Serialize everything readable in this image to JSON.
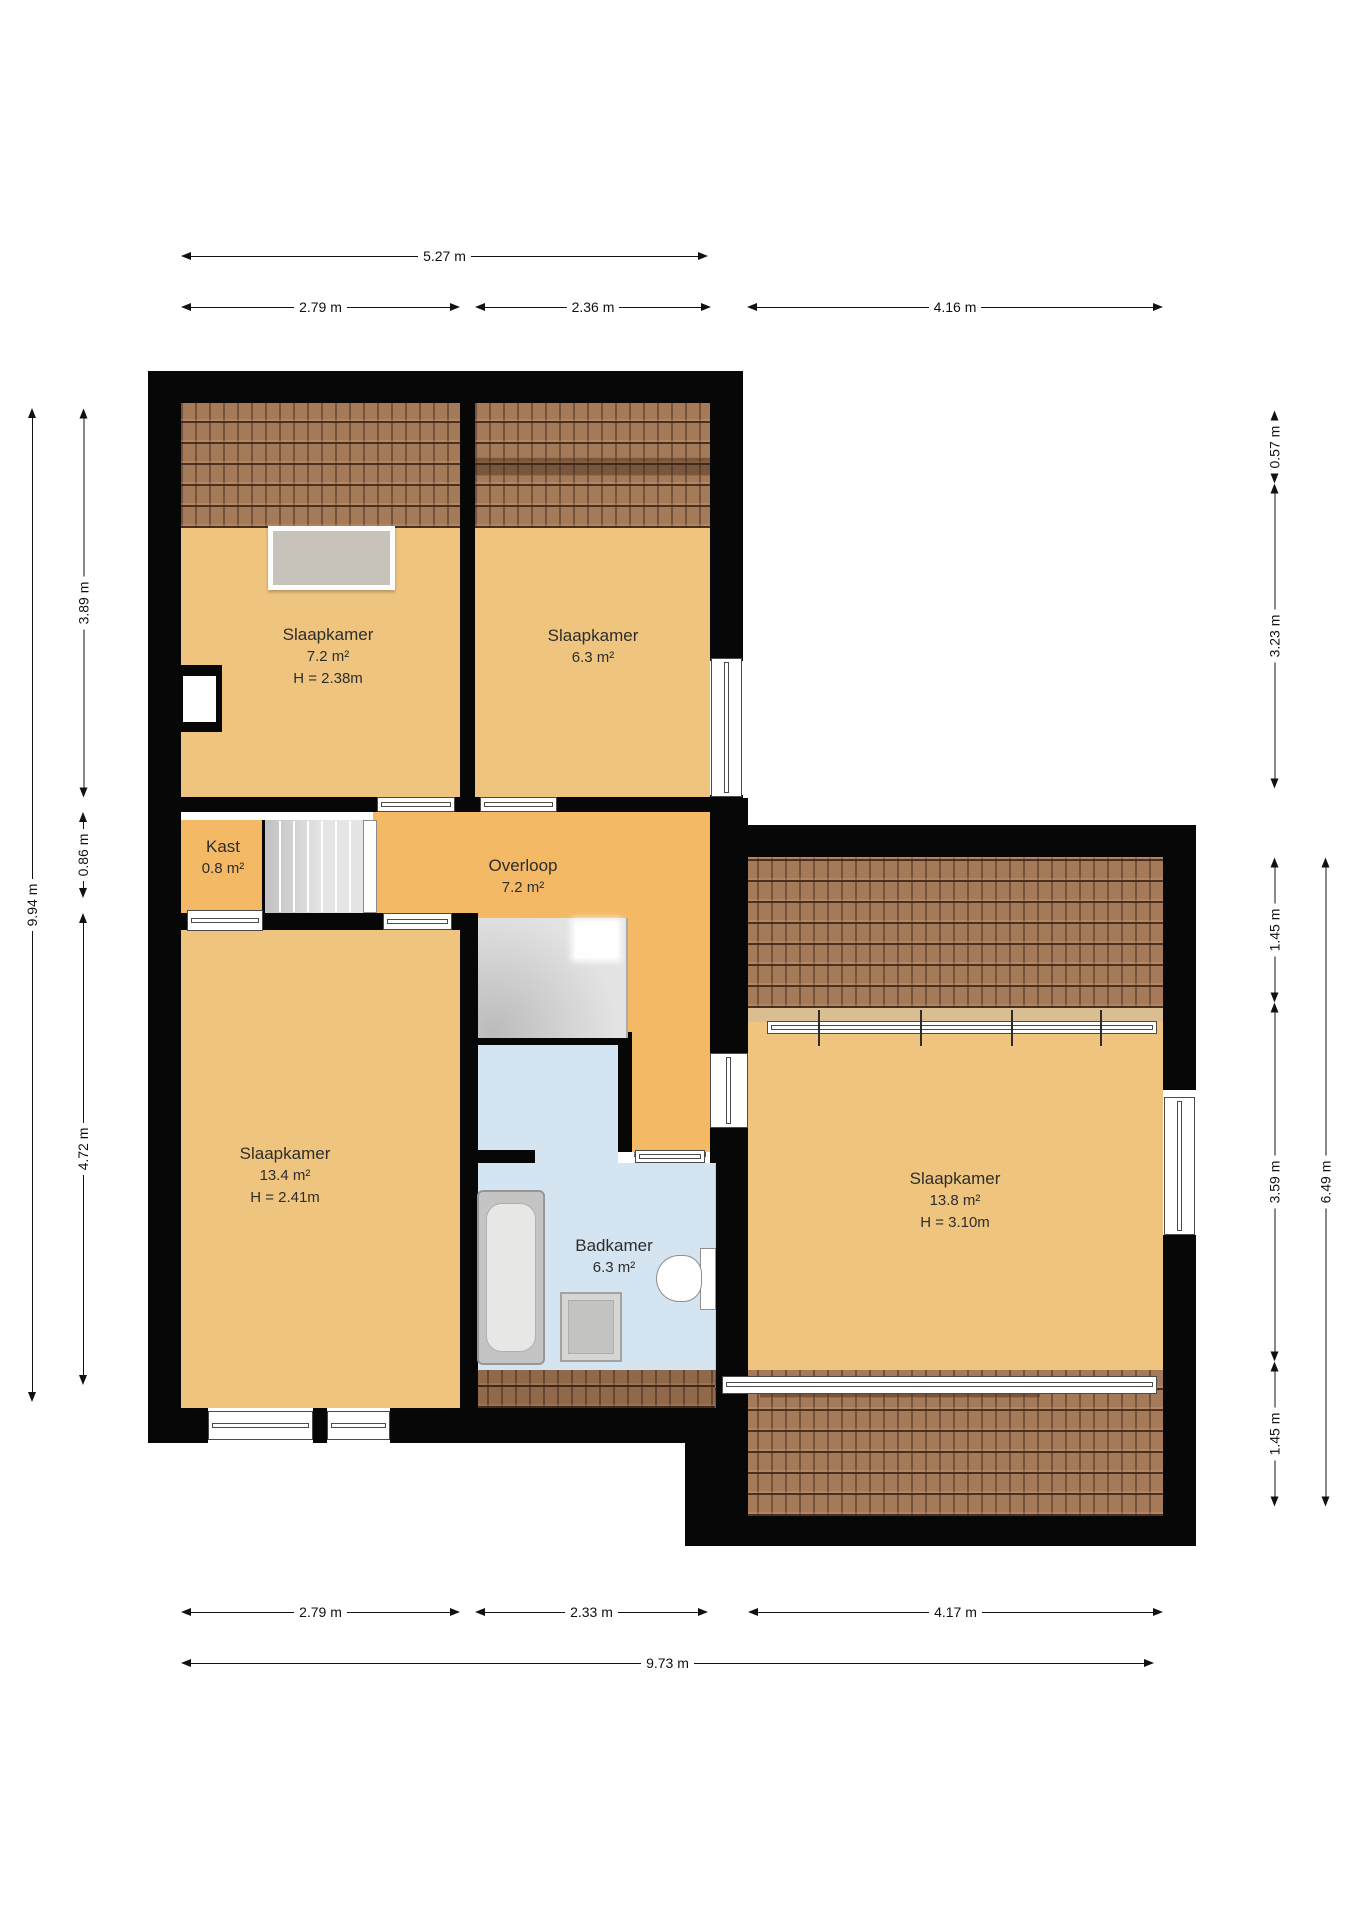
{
  "meta": {
    "type": "floorplan",
    "unit": "m",
    "floor_note": ""
  },
  "colors": {
    "bedroom": "#eec47e",
    "hall": "#f3b964",
    "bath": "#d5e4f1",
    "roof": "#a57a58",
    "wall": "#070707",
    "tan": "#dabd90",
    "stair": "#dcdcdc",
    "label": "#2d2d2d"
  },
  "rooms": [
    {
      "id": "slaapkamer-1",
      "lines": [
        "Slaapkamer",
        "7.2 m²",
        "H = 2.38m"
      ],
      "cx": 328,
      "cy": 657
    },
    {
      "id": "slaapkamer-2",
      "lines": [
        "Slaapkamer",
        "6.3 m²"
      ],
      "cx": 593,
      "cy": 647
    },
    {
      "id": "kast",
      "lines": [
        "Kast",
        "0.8 m²"
      ],
      "cx": 223,
      "cy": 858
    },
    {
      "id": "overloop",
      "lines": [
        "Overloop",
        "7.2 m²"
      ],
      "cx": 523,
      "cy": 877
    },
    {
      "id": "slaapkamer-3",
      "lines": [
        "Slaapkamer",
        "13.4 m²",
        "H = 2.41m"
      ],
      "cx": 285,
      "cy": 1176
    },
    {
      "id": "badkamer",
      "lines": [
        "Badkamer",
        "6.3 m²"
      ],
      "cx": 614,
      "cy": 1257
    },
    {
      "id": "slaapkamer-4",
      "lines": [
        "Slaapkamer",
        "13.8 m²",
        "H = 3.10m"
      ],
      "cx": 955,
      "cy": 1201
    }
  ],
  "floors": [
    {
      "id": "floor-slaapkamer-1",
      "x": 181,
      "y": 403,
      "w": 279,
      "h": 394,
      "fill": "bedroom"
    },
    {
      "id": "floor-slaapkamer-2",
      "x": 475,
      "y": 403,
      "w": 235,
      "h": 394,
      "fill": "bedroom"
    },
    {
      "id": "floor-kast",
      "x": 181,
      "y": 820,
      "w": 84,
      "h": 93,
      "fill": "hall"
    },
    {
      "id": "floor-overloop-main",
      "x": 373,
      "y": 812,
      "w": 337,
      "h": 101,
      "fill": "hall"
    },
    {
      "id": "floor-overloop-mid",
      "x": 478,
      "y": 913,
      "w": 232,
      "h": 10,
      "fill": "hall"
    },
    {
      "id": "floor-overloop-east",
      "x": 628,
      "y": 918,
      "w": 82,
      "h": 234,
      "fill": "hall"
    },
    {
      "id": "floor-slaapkamer-3",
      "x": 181,
      "y": 930,
      "w": 279,
      "h": 478,
      "fill": "bedroom"
    },
    {
      "id": "floor-shower",
      "x": 478,
      "y": 1045,
      "w": 140,
      "h": 105,
      "fill": "bath"
    },
    {
      "id": "floor-bath-link",
      "x": 535,
      "y": 1150,
      "w": 83,
      "h": 13,
      "fill": "bath"
    },
    {
      "id": "floor-badkamer",
      "x": 478,
      "y": 1163,
      "w": 238,
      "h": 207,
      "fill": "bath"
    },
    {
      "id": "floor-slaapkamer-4",
      "x": 715,
      "y": 857,
      "w": 448,
      "h": 659,
      "fill": "bedroom"
    },
    {
      "id": "floor-tan-strip",
      "x": 715,
      "y": 1008,
      "w": 448,
      "h": 14,
      "fill": "tan"
    }
  ],
  "roofs": [
    {
      "id": "roof-top-left",
      "x": 181,
      "y": 403,
      "w": 531,
      "h": 125,
      "dark": false
    },
    {
      "id": "roof-right-top",
      "x": 715,
      "y": 857,
      "w": 448,
      "h": 151,
      "dark": false
    },
    {
      "id": "roof-bath-strip",
      "x": 473,
      "y": 1370,
      "w": 243,
      "h": 38,
      "dark": true
    },
    {
      "id": "roof-right-bottom",
      "x": 715,
      "y": 1370,
      "w": 448,
      "h": 146,
      "dark": false
    }
  ],
  "roof_shades": [
    {
      "id": "roof-shade-top",
      "x": 473,
      "y": 457,
      "w": 239,
      "h": 17
    },
    {
      "id": "roof-shade-bottom",
      "x": 760,
      "y": 1377,
      "w": 280,
      "h": 19
    }
  ],
  "walls": [
    [
      148,
      371,
      595,
      32
    ],
    [
      148,
      371,
      33,
      1072
    ],
    [
      710,
      371,
      33,
      290
    ],
    [
      710,
      795,
      33,
      30
    ],
    [
      460,
      371,
      15,
      441
    ],
    [
      181,
      797,
      196,
      15
    ],
    [
      455,
      797,
      25,
      15
    ],
    [
      557,
      797,
      156,
      15
    ],
    [
      148,
      913,
      39,
      17
    ],
    [
      263,
      913,
      120,
      17
    ],
    [
      452,
      913,
      26,
      17
    ],
    [
      460,
      913,
      18,
      497
    ],
    [
      262,
      820,
      4,
      93
    ],
    [
      465,
      1032,
      167,
      13
    ],
    [
      618,
      1045,
      14,
      107
    ],
    [
      478,
      1150,
      57,
      13
    ],
    [
      710,
      798,
      38,
      27
    ],
    [
      710,
      825,
      38,
      228
    ],
    [
      710,
      1128,
      38,
      35
    ],
    [
      716,
      1163,
      32,
      245
    ],
    [
      685,
      1408,
      63,
      138
    ],
    [
      148,
      1408,
      60,
      35
    ],
    [
      313,
      1408,
      14,
      35
    ],
    [
      390,
      1408,
      326,
      35
    ],
    [
      743,
      825,
      453,
      32
    ],
    [
      1163,
      825,
      33,
      265
    ],
    [
      1163,
      1235,
      33,
      311
    ],
    [
      685,
      1516,
      511,
      30
    ]
  ],
  "windows": [
    {
      "id": "window-slaapkamer2-east",
      "x": 711,
      "y": 658,
      "w": 31,
      "h": 139,
      "orient": "v"
    },
    {
      "id": "window-slaapkamer4-topband",
      "x": 767,
      "y": 1021,
      "w": 390,
      "h": 13,
      "orient": "h"
    },
    {
      "id": "window-slaapkamer4-east",
      "x": 1164,
      "y": 1097,
      "w": 31,
      "h": 138,
      "orient": "v"
    },
    {
      "id": "window-slaapkamer3-south-a",
      "x": 208,
      "y": 1411,
      "w": 105,
      "h": 29,
      "orient": "h"
    },
    {
      "id": "window-slaapkamer3-south-b",
      "x": 327,
      "y": 1411,
      "w": 63,
      "h": 29,
      "orient": "h"
    },
    {
      "id": "window-roofband-bottom",
      "x": 722,
      "y": 1376,
      "w": 435,
      "h": 18,
      "orient": "h"
    },
    {
      "id": "kast-door-band",
      "x": 187,
      "y": 910,
      "w": 76,
      "h": 21,
      "orient": "h"
    }
  ],
  "window_ticks": {
    "band_x": [
      818,
      920,
      1011,
      1100
    ],
    "y1": 1010,
    "y2": 1046
  },
  "door_bands": [
    {
      "id": "door-slaapkamer-1",
      "x": 377,
      "y": 797,
      "w": 78,
      "h": 15,
      "orient": "h"
    },
    {
      "id": "door-slaapkamer-2",
      "x": 480,
      "y": 797,
      "w": 77,
      "h": 15,
      "orient": "h"
    },
    {
      "id": "door-slaapkamer-3",
      "x": 383,
      "y": 913,
      "w": 69,
      "h": 17,
      "orient": "h"
    },
    {
      "id": "door-badkamer",
      "x": 635,
      "y": 1150,
      "w": 70,
      "h": 13,
      "orient": "h"
    },
    {
      "id": "door-slaapkamer-4",
      "x": 710,
      "y": 1053,
      "w": 38,
      "h": 75,
      "orient": "v"
    }
  ],
  "door_arcs": [
    {
      "id": "door-arc-slaapkamer-1",
      "path": "M455,800 A75,75 0 0 0 380,725",
      "leaf": [
        380,
        800,
        380,
        725
      ]
    },
    {
      "id": "door-arc-slaapkamer-2",
      "path": "M480,800 A77,77 0 0 1 557,723",
      "leaf": [
        557,
        800,
        557,
        723
      ]
    },
    {
      "id": "door-arc-slaapkamer-3",
      "path": "M452,925 A69,69 0 0 1 383,994",
      "leaf": [
        383,
        925,
        383,
        994
      ]
    },
    {
      "id": "door-arc-badkamer",
      "path": "M635,1157 A70,70 0 0 1 705,1087",
      "leaf": [
        705,
        1157,
        705,
        1087
      ]
    },
    {
      "id": "door-arc-slaapkamer-4",
      "path": "M748,1128 A75,75 0 0 0 823,1053",
      "leaf": [
        748,
        1053,
        823,
        1053
      ]
    }
  ],
  "extras": {
    "dormer": {
      "id": "dormer-window",
      "x": 268,
      "y": 526,
      "w": 127,
      "h": 64
    },
    "niche_outer": {
      "id": "wall-niche-outer",
      "x": 177,
      "y": 665,
      "w": 45,
      "h": 67
    },
    "niche_inner": {
      "id": "wall-niche-inner",
      "x": 183,
      "y": 676,
      "w": 33,
      "h": 46
    }
  },
  "stairs": {
    "flight": {
      "id": "stairs-upper-flight",
      "x": 265,
      "y": 820,
      "w": 98,
      "h": 93,
      "treads_x": [
        279,
        293,
        307,
        321,
        335,
        349
      ]
    },
    "railing": {
      "id": "stairs-railing",
      "x": 363,
      "y": 820,
      "w": 14,
      "h": 93
    },
    "winder": {
      "id": "stairs-winder",
      "x": 478,
      "y": 918,
      "w": 150,
      "h": 120,
      "pivot": [
        488,
        1034
      ],
      "edges": [
        [
          520,
          918
        ],
        [
          562,
          918
        ],
        [
          604,
          918
        ],
        [
          628,
          938
        ],
        [
          628,
          972
        ],
        [
          628,
          1006
        ]
      ],
      "landing": {
        "x": 575,
        "y": 922,
        "w": 43,
        "h": 36
      }
    },
    "rail2": {
      "x": 626,
      "y": 918,
      "w": 2,
      "h": 120
    }
  },
  "fixtures": {
    "bathtub": {
      "id": "bathtub",
      "x": 477,
      "y": 1190,
      "w": 68,
      "h": 175
    },
    "washer": {
      "id": "washer",
      "x": 560,
      "y": 1292,
      "w": 62,
      "h": 70
    },
    "toilet_tank": {
      "id": "toilet-tank",
      "x": 700,
      "y": 1248,
      "w": 16,
      "h": 62
    },
    "toilet_bowl": {
      "id": "toilet-bowl",
      "x": 656,
      "y": 1255,
      "w": 46,
      "h": 47
    },
    "shower_head": {
      "id": "shower-head",
      "cx": 519,
      "cy": 1089,
      "r": 14,
      "arm": [
        478,
        1088,
        507,
        1089
      ]
    }
  },
  "dims": {
    "h": [
      {
        "id": "dim-527",
        "y": 256,
        "x1": 181,
        "x2": 708,
        "label": "5.27 m"
      },
      {
        "id": "dim-279-top",
        "y": 307,
        "x1": 181,
        "x2": 460,
        "label": "2.79 m"
      },
      {
        "id": "dim-236-top",
        "y": 307,
        "x1": 475,
        "x2": 711,
        "label": "2.36 m"
      },
      {
        "id": "dim-416-top",
        "y": 307,
        "x1": 747,
        "x2": 1163,
        "label": "4.16 m"
      },
      {
        "id": "dim-279-bottom",
        "y": 1612,
        "x1": 181,
        "x2": 460,
        "label": "2.79 m"
      },
      {
        "id": "dim-233-bottom",
        "y": 1612,
        "x1": 475,
        "x2": 708,
        "label": "2.33 m"
      },
      {
        "id": "dim-417-bottom",
        "y": 1612,
        "x1": 748,
        "x2": 1163,
        "label": "4.17 m"
      },
      {
        "id": "dim-973-bottom",
        "y": 1663,
        "x1": 181,
        "x2": 1154,
        "label": "9.73 m"
      }
    ],
    "v": [
      {
        "id": "dim-994-left",
        "x": 32,
        "y1": 408,
        "y2": 1402,
        "label": "9.94 m"
      },
      {
        "id": "dim-389-left",
        "x": 83,
        "y1": 408,
        "y2": 797,
        "label": "3.89 m"
      },
      {
        "id": "dim-086-left",
        "x": 83,
        "y1": 812,
        "y2": 898,
        "label": "0.86 m"
      },
      {
        "id": "dim-472-left",
        "x": 83,
        "y1": 913,
        "y2": 1385,
        "label": "4.72 m"
      },
      {
        "id": "dim-057-right",
        "x": 1274,
        "y1": 426,
        "y2": 483,
        "label": "0.57 m"
      },
      {
        "id": "dim-323-right",
        "x": 1274,
        "y1": 483,
        "y2": 788,
        "label": "3.23 m"
      },
      {
        "id": "dim-145a-right",
        "x": 1274,
        "y1": 857,
        "y2": 1002,
        "label": "1.45 m"
      },
      {
        "id": "dim-359-right",
        "x": 1274,
        "y1": 1002,
        "y2": 1361,
        "label": "3.59 m"
      },
      {
        "id": "dim-145b-right",
        "x": 1274,
        "y1": 1361,
        "y2": 1506,
        "label": "1.45 m"
      },
      {
        "id": "dim-649-right",
        "x": 1325,
        "y1": 857,
        "y2": 1506,
        "label": "6.49 m"
      }
    ]
  }
}
